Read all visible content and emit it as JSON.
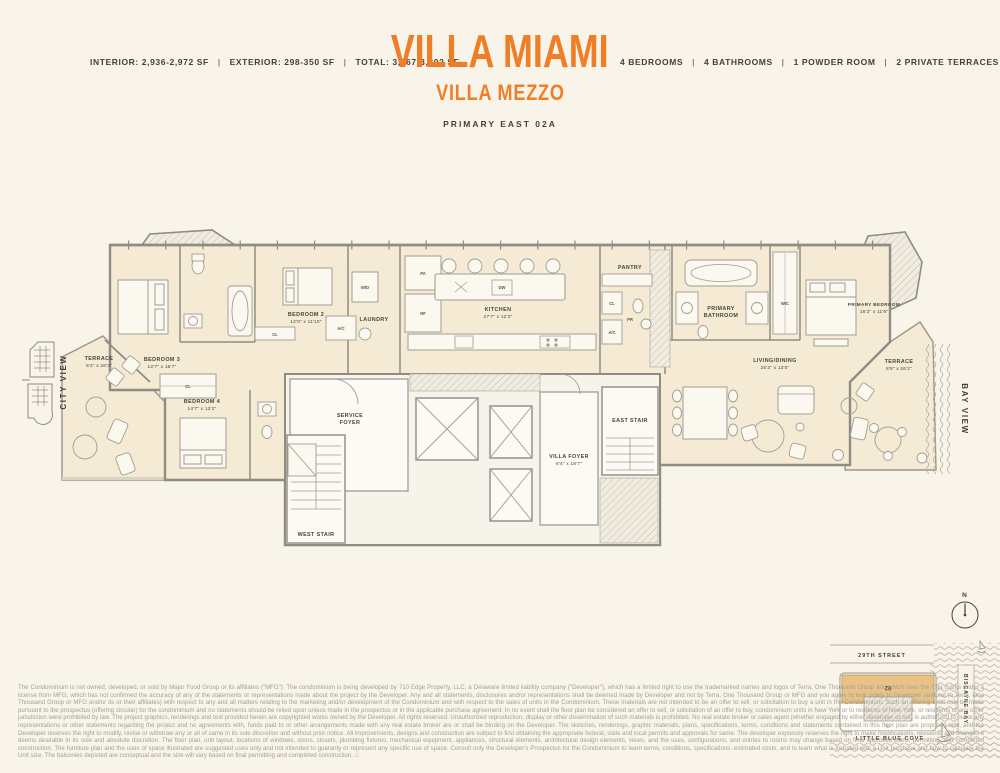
{
  "page": {
    "background": "#f9f4ea",
    "accent_orange": "#f07e26",
    "ink": "#453f37"
  },
  "header": {
    "left_specs": [
      "INTERIOR: 2,936-2,972 SF",
      "EXTERIOR: 298-350 SF",
      "TOTAL: 3,267-3,302 SF"
    ],
    "separator": "|",
    "title": "VILLA MIAMI",
    "subtitle": "VILLA MEZZO",
    "plan_name": "PRIMARY EAST 02A",
    "right_specs": [
      "4 BEDROOMS",
      "4 BATHROOMS",
      "1 POWDER ROOM",
      "2 PRIVATE TERRACES"
    ]
  },
  "views": {
    "left": "CITY VIEW",
    "right": "BAY VIEW"
  },
  "plan": {
    "rooms": {
      "terrace_west": {
        "name": "TERRACE",
        "dims": "8'4\" x 26'2\""
      },
      "bedroom3": {
        "name": "BEDROOM 3",
        "dims": "12'7\" x 16'7\""
      },
      "bedroom2": {
        "name": "BEDROOM 2",
        "dims": "12'0\" x 11'10\""
      },
      "bedroom4": {
        "name": "BEDROOM 4",
        "dims": "14'7\" x 13'2\""
      },
      "laundry": {
        "name": "LAUNDRY"
      },
      "kitchen": {
        "name": "KITCHEN",
        "dims": "27'7\" x 12'2\""
      },
      "pantry": {
        "name": "PANTRY"
      },
      "primary_bathroom_1": "PRIMARY",
      "primary_bathroom_2": "BATHROOM",
      "wic": {
        "name": "WIC"
      },
      "primary_bedroom": {
        "name": "PRIMARY BEDROOM",
        "dims": "16'2\" x 11'6\""
      },
      "living_dining": {
        "name": "LIVING/DINING",
        "dims": "25'2\" x 13'5\""
      },
      "service_foyer_1": "SERVICE",
      "service_foyer_2": "FOYER",
      "villa_foyer": {
        "name": "VILLA FOYER",
        "dims": "8'4\" x 18'7\""
      },
      "east_stair": {
        "name": "EAST STAIR"
      },
      "west_stair": {
        "name": "WEST STAIR"
      },
      "terrace_east": {
        "name": "TERRACE",
        "dims": "8'8\" x 26'2\""
      }
    },
    "tags": {
      "wd": "W/D",
      "pa": "PA",
      "rf": "RF",
      "dw": "DW",
      "cl": "CL",
      "cl2": "CL",
      "ac": "A/C",
      "ac2": "A/C",
      "pr": "PR"
    }
  },
  "sitemap": {
    "compass": "N",
    "street": "29TH STREET",
    "bay": "BISCAYNE BAY",
    "cove": "LITTLE BLUE COVE",
    "unit": "02"
  },
  "disclaimer": {
    "text": "The Condominium is not owned, developed, or sold by Major Food Group or its affiliates (\"MFG\"). The condominium is being developed by 710 Edge Property, LLC, a Delaware limited liability company (\"Developer\"), which has a limited right to use the trademarked names and logos of Terra, One Thousand Group and which uses the Villa marks under a license from MFG, which has not confirmed the accuracy of any of the statements or representations made about the project by the Developer. Any and all statements, disclosures and/or representations shall be deemed made by Developer and not by Terra, One Thousand Group or MFG and you agree to look solely to Developer (and not to Terra, One Thousand Group or MFG and/or its or their affiliates) with respect to any and all matters relating to the marketing and/or development of the Condominium and with respect to the sales of units in the Condominium. These materials are not intended to be an offer to sell, or solicitation to buy a unit in the Condominium. Such an offering shall only be made pursuant to the prospectus (offering circular) for the condominium and no statements should be relied upon unless made in the prospectus or in the applicable purchase agreement. In no event shall the floor plan be considered an offer to sell, or solicitation of an offer to buy, condominium units in New York or to residents of New York, or residents of any other jurisdiction were prohibited by law. The project graphics, renderings and text provided herein are copyrighted works owned by the Developer. All rights reserved. Unauthorized reproduction, display or other dissemination of such materials is prohibited. No real estate broker or sales agent (whether engaged by either developer or not) is authorized to make any representations or other statements regarding the project and no agreements with, funds paid to or other arrangements made with any real estate broker are or shall be binding on the Developer. The sketches, renderings, graphic materials, plans, specifications, terms, conditions and statements contained in this floor plan are proposed only, and the Developer reserves the right to modify, revise or withdraw any or all of same in its sole discretion and without prior notice. All improvements, designs and construction are subject to first obtaining the appropriate federal, state and local permits and approvals for same. The developer expressly reserves the right to make modifications, revisions, and changes it deems desirable in its sole and absolute discretion. The floor plan, unit layout, locations of windows, doors, closets, plumbing fixtures, mechanical equipment, appliances, structural elements, architectural design elements, views, and the uses, configurations, and entries to rooms may change based on final approved plans, permitting, and completed construction. The furniture plan and the uses of space illustrated are suggested uses only and not intended to guaranty or represent any specific use of space. Consult only the Developer's Prospectus for the Condominium to learn terms, conditions, specifications, estimated costs, and to learn what is included with a Unit purchase and how to calculate the Unit size. The balconies depicted are conceptual and the size will vary based on final permitting and completed construction.",
    "equal_housing_icon": "⌂"
  }
}
